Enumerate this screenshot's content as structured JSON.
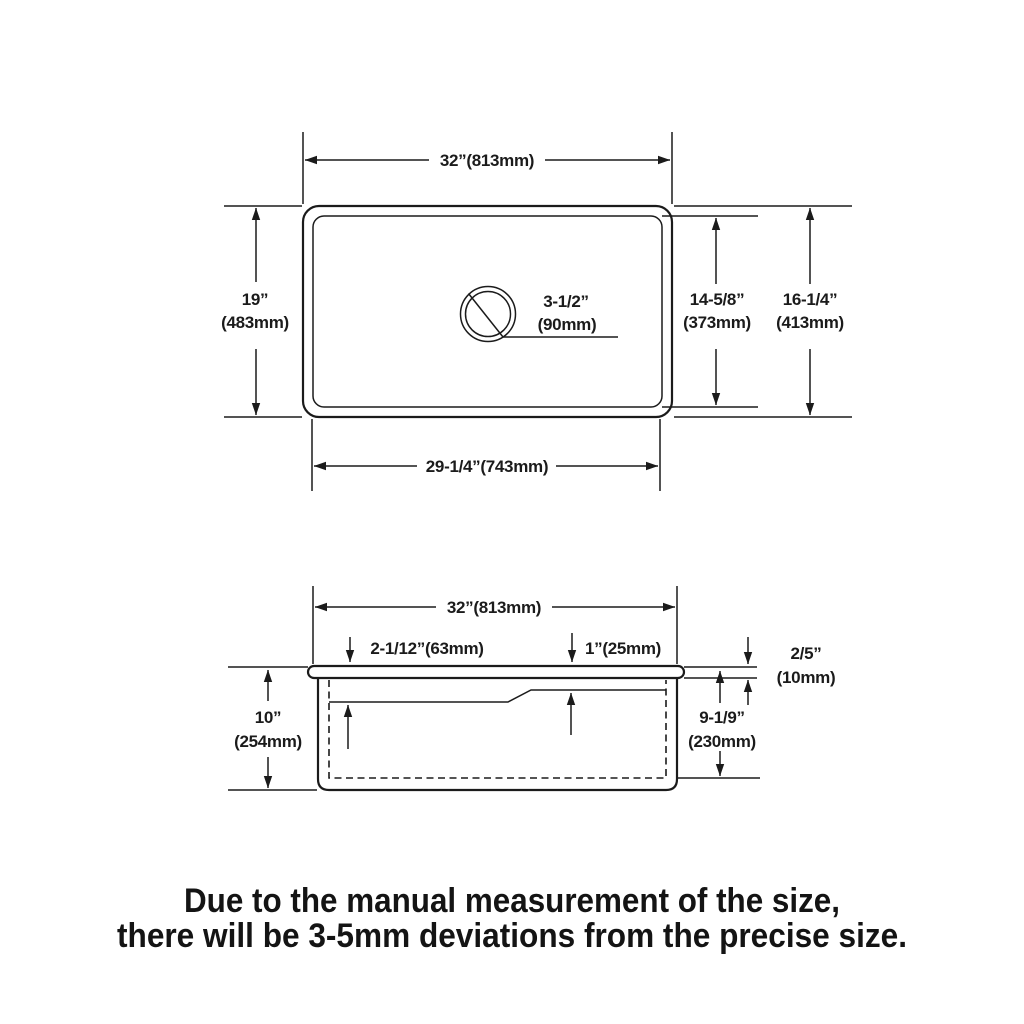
{
  "top_view": {
    "overall_width": "32”(813mm)",
    "overall_depth_in": "19”",
    "overall_depth_mm": "(483mm)",
    "drain_size_in": "3-1/2”",
    "drain_size_mm": "(90mm)",
    "bowl_front_back_in": "14-5/8”",
    "bowl_front_back_mm": "(373mm)",
    "rim_front_back_in": "16-1/4”",
    "rim_front_back_mm": "(413mm)",
    "bowl_length": "29-1/4”(743mm)"
  },
  "side_view": {
    "overall_width": "32”(813mm)",
    "left_step_depth": "2-1/12”(63mm)",
    "right_step_depth": "1”(25mm)",
    "rim_thickness_in": "2/5”",
    "rim_thickness_mm": "(10mm)",
    "overall_depth_in": "10”",
    "overall_depth_mm": "(254mm)",
    "bowl_depth_in": "9-1/9”",
    "bowl_depth_mm": "(230mm)"
  },
  "note": {
    "line1": "Due to the manual measurement of the size,",
    "line2": "there will be 3-5mm deviations from the precise size."
  }
}
